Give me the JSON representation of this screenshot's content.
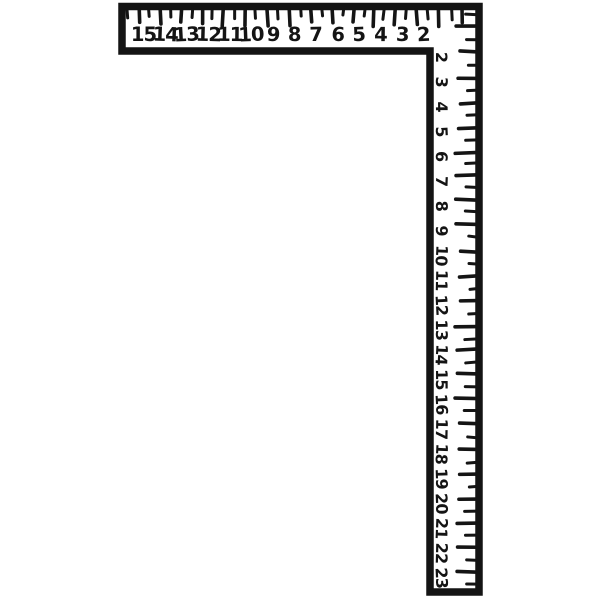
{
  "illustration": {
    "subject": "carpenter-framing-square",
    "style": "hand-drawn black line art on white background",
    "colors": {
      "ink": "#141414",
      "paper": "#ffffff"
    },
    "horizontal_arm": {
      "inch_labels": [
        "15",
        "14",
        "13",
        "12",
        "11",
        "10",
        "9",
        "8",
        "7",
        "6",
        "5",
        "4",
        "3",
        "2"
      ],
      "tick_count": 32
    },
    "vertical_arm": {
      "inch_labels": [
        "2",
        "3",
        "4",
        "5",
        "6",
        "7",
        "8",
        "9",
        "10",
        "11",
        "12",
        "13",
        "14",
        "15",
        "16",
        "17",
        "18",
        "19",
        "20",
        "21",
        "22",
        "23"
      ],
      "tick_count": 47,
      "label_rotation_deg": 90
    }
  }
}
